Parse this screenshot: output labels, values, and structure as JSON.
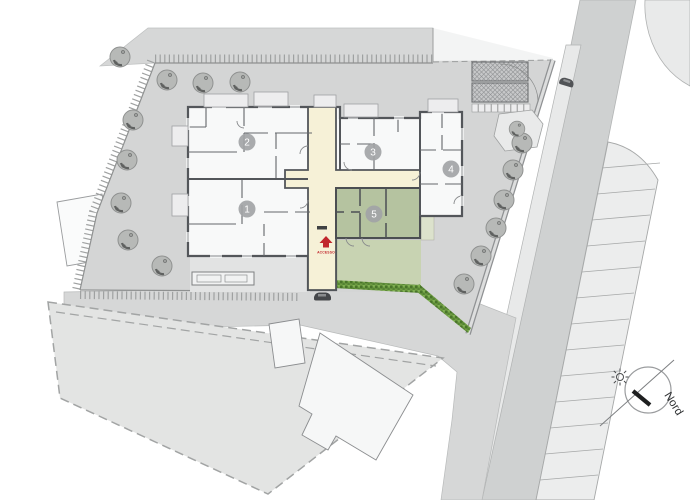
{
  "plan": {
    "title": "site-plan",
    "access_label": "ACCESSO",
    "north_label": "Nord",
    "units": [
      {
        "label": "1"
      },
      {
        "label": "2"
      },
      {
        "label": "3"
      },
      {
        "label": "4"
      },
      {
        "label": "5"
      }
    ],
    "parking": {
      "stall_count": 13
    },
    "colors": {
      "road": "#cfd1d1",
      "secondary_road": "#d6d7d7",
      "site_ground": "#d4d5d5",
      "sidewalk": "#e8e9e9",
      "parking_stall": "#eceded",
      "neighbour_parcel": "#e3e4e3",
      "building_wall": "#53565a",
      "circulation": "#f6f1d7",
      "unit5_green": "#b5c3a0",
      "garden_green": "#c8d3b2",
      "hedge_green": "#5d8c3c",
      "access_red": "#c1272d",
      "tree_gray": "#b7b9b7"
    }
  }
}
